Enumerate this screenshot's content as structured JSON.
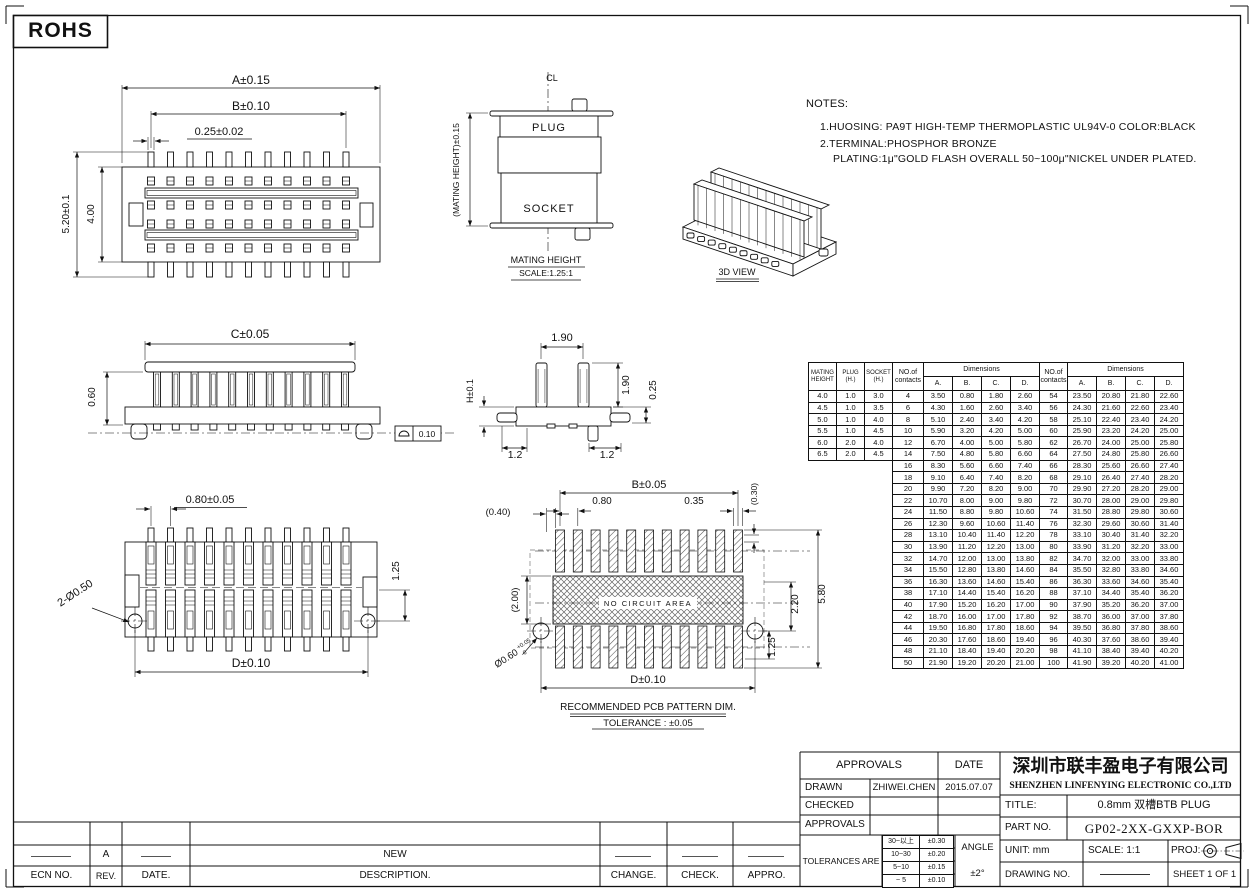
{
  "rohs": "ROHS",
  "notes": {
    "title": "NOTES:",
    "items": [
      "1.HUOSING: PA9T HIGH-TEMP THERMOPLASTIC UL94V-0 COLOR:BLACK",
      "2.TERMINAL:PHOSPHOR BRONZE",
      "PLATING:1μ\"GOLD FLASH OVERALL 50~100μ\"NICKEL UNDER PLATED."
    ]
  },
  "views": {
    "top": {
      "a": "A±0.15",
      "b": "B±0.10",
      "pin": "0.25±0.02",
      "h1": "5.20±0.1",
      "h2": "4.00"
    },
    "mating": {
      "cl": "CL",
      "plug": "PLUG",
      "socket": "SOCKET",
      "dim": "(MATING HEIGHT)±0.15",
      "label": "MATING HEIGHT",
      "scale": "SCALE:1.25:1"
    },
    "v3d": {
      "label": "3D VIEW"
    },
    "side": {
      "c": "C±0.05",
      "h": "0.60",
      "flat": "0.10"
    },
    "pin": {
      "top": "1.90",
      "right": "1.90",
      "t025": "0.25",
      "l12": "1.2",
      "r12": "1.2",
      "h": "H±0.1"
    },
    "bottom": {
      "pitch": "0.80±0.05",
      "holes": "2-Ø0.50",
      "v125": "1.25",
      "d": "D±0.10"
    },
    "pcb": {
      "b": "B±0.05",
      "p080": "0.80",
      "p035": "0.35",
      "p030": "(0.30)",
      "p040": "(0.40)",
      "p200": "(2.00)",
      "p220": "2.20",
      "p580": "5.80",
      "p125": "1.25",
      "hole": "Ø0.60",
      "hole_up": "+0.05",
      "hole_dn": "-0",
      "nocircuit": "NO CIRCUIT AREA",
      "d": "D±0.10",
      "label": "RECOMMENDED PCB PATTERN DIM.",
      "tol": "TOLERANCE : ±0.05"
    }
  },
  "spec_table": {
    "headers": [
      "MATING HEIGHT",
      "PLUG (H.)",
      "SOCKET (H.)"
    ],
    "rows": [
      [
        "4.0",
        "1.0",
        "3.0"
      ],
      [
        "4.5",
        "1.0",
        "3.5"
      ],
      [
        "5.0",
        "1.0",
        "4.0"
      ],
      [
        "5.5",
        "1.0",
        "4.5"
      ],
      [
        "6.0",
        "2.0",
        "4.0"
      ],
      [
        "6.5",
        "2.0",
        "4.5"
      ]
    ]
  },
  "contact_table": {
    "no_label": "NO.of contacts",
    "dims_label": "Dimensions",
    "cols": [
      "A.",
      "B.",
      "C.",
      "D."
    ],
    "rows": [
      [
        "4",
        "3.50",
        "0.80",
        "1.80",
        "2.60",
        "54",
        "23.50",
        "20.80",
        "21.80",
        "22.60"
      ],
      [
        "6",
        "4.30",
        "1.60",
        "2.60",
        "3.40",
        "56",
        "24.30",
        "21.60",
        "22.60",
        "23.40"
      ],
      [
        "8",
        "5.10",
        "2.40",
        "3.40",
        "4.20",
        "58",
        "25.10",
        "22.40",
        "23.40",
        "24.20"
      ],
      [
        "10",
        "5.90",
        "3.20",
        "4.20",
        "5.00",
        "60",
        "25.90",
        "23.20",
        "24.20",
        "25.00"
      ],
      [
        "12",
        "6.70",
        "4.00",
        "5.00",
        "5.80",
        "62",
        "26.70",
        "24.00",
        "25.00",
        "25.80"
      ],
      [
        "14",
        "7.50",
        "4.80",
        "5.80",
        "6.60",
        "64",
        "27.50",
        "24.80",
        "25.80",
        "26.60"
      ],
      [
        "16",
        "8.30",
        "5.60",
        "6.60",
        "7.40",
        "66",
        "28.30",
        "25.60",
        "26.60",
        "27.40"
      ],
      [
        "18",
        "9.10",
        "6.40",
        "7.40",
        "8.20",
        "68",
        "29.10",
        "26.40",
        "27.40",
        "28.20"
      ],
      [
        "20",
        "9.90",
        "7.20",
        "8.20",
        "9.00",
        "70",
        "29.90",
        "27.20",
        "28.20",
        "29.00"
      ],
      [
        "22",
        "10.70",
        "8.00",
        "9.00",
        "9.80",
        "72",
        "30.70",
        "28.00",
        "29.00",
        "29.80"
      ],
      [
        "24",
        "11.50",
        "8.80",
        "9.80",
        "10.60",
        "74",
        "31.50",
        "28.80",
        "29.80",
        "30.60"
      ],
      [
        "26",
        "12.30",
        "9.60",
        "10.60",
        "11.40",
        "76",
        "32.30",
        "29.60",
        "30.60",
        "31.40"
      ],
      [
        "28",
        "13.10",
        "10.40",
        "11.40",
        "12.20",
        "78",
        "33.10",
        "30.40",
        "31.40",
        "32.20"
      ],
      [
        "30",
        "13.90",
        "11.20",
        "12.20",
        "13.00",
        "80",
        "33.90",
        "31.20",
        "32.20",
        "33.00"
      ],
      [
        "32",
        "14.70",
        "12.00",
        "13.00",
        "13.80",
        "82",
        "34.70",
        "32.00",
        "33.00",
        "33.80"
      ],
      [
        "34",
        "15.50",
        "12.80",
        "13.80",
        "14.60",
        "84",
        "35.50",
        "32.80",
        "33.80",
        "34.60"
      ],
      [
        "36",
        "16.30",
        "13.60",
        "14.60",
        "15.40",
        "86",
        "36.30",
        "33.60",
        "34.60",
        "35.40"
      ],
      [
        "38",
        "17.10",
        "14.40",
        "15.40",
        "16.20",
        "88",
        "37.10",
        "34.40",
        "35.40",
        "36.20"
      ],
      [
        "40",
        "17.90",
        "15.20",
        "16.20",
        "17.00",
        "90",
        "37.90",
        "35.20",
        "36.20",
        "37.00"
      ],
      [
        "42",
        "18.70",
        "16.00",
        "17.00",
        "17.80",
        "92",
        "38.70",
        "36.00",
        "37.00",
        "37.80"
      ],
      [
        "44",
        "19.50",
        "16.80",
        "17.80",
        "18.60",
        "94",
        "39.50",
        "36.80",
        "37.80",
        "38.60"
      ],
      [
        "46",
        "20.30",
        "17.60",
        "18.60",
        "19.40",
        "96",
        "40.30",
        "37.60",
        "38.60",
        "39.40"
      ],
      [
        "48",
        "21.10",
        "18.40",
        "19.40",
        "20.20",
        "98",
        "41.10",
        "38.40",
        "39.40",
        "40.20"
      ],
      [
        "50",
        "21.90",
        "19.20",
        "20.20",
        "21.00",
        "100",
        "41.90",
        "39.20",
        "40.20",
        "41.00"
      ]
    ]
  },
  "title_block": {
    "approvals": "APPROVALS",
    "date": "DATE",
    "drawn": "DRAWN",
    "drawn_by": "ZHIWEI.CHEN",
    "drawn_date": "2015.07.07",
    "checked": "CHECKED",
    "approvals2": "APPROVALS",
    "tolerances": "TOLERANCES ARE",
    "tol_rows": [
      [
        "30~以上",
        "±0.30"
      ],
      [
        "10~30",
        "±0.20"
      ],
      [
        "5~10",
        "±0.15"
      ],
      [
        "~ 5",
        "±0.10"
      ]
    ],
    "angle": "ANGLE",
    "angle_val": "±2°",
    "company_cn": "深圳市联丰盈电子有限公司",
    "company_en": "SHENZHEN LINFENYING ELECTRONIC CO.,LTD",
    "title_label": "TITLE:",
    "title_value": "0.8mm 双槽BTB PLUG",
    "part_label": "PART NO.",
    "part_value": "GP02-2XX-GXXP-BOR",
    "unit": "UNIT: mm",
    "scale": "SCALE: 1:1",
    "proj": "PROJ:",
    "drawing_label": "DRAWING NO.",
    "sheet": "SHEET 1 OF 1"
  },
  "revision": {
    "ecn": "ECN NO.",
    "rev": "REV.",
    "date": "DATE.",
    "desc": "DESCRIPTION.",
    "change": "CHANGE.",
    "check": "CHECK.",
    "appro": "APPRO.",
    "row_rev": "A",
    "row_desc": "NEW"
  }
}
